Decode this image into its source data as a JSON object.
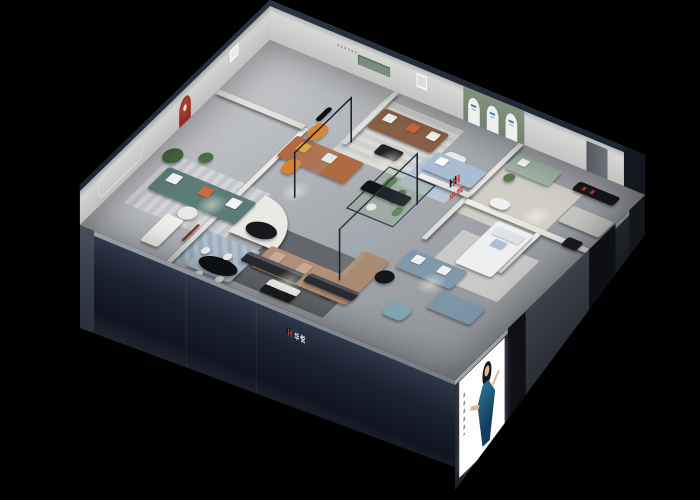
{
  "brand": {
    "logo_letter": "H",
    "name": "华悦"
  },
  "signs": {
    "interior": {
      "text": "华悦",
      "color": "#c0392b"
    },
    "fascia": {
      "text": "华悦",
      "color": "#eeeeee"
    }
  },
  "poster": {
    "title": "model in blue dress lightbox poster"
  },
  "palette": {
    "background": "#000000",
    "exterior_wall": "#1a2130",
    "wall_cap": "#2b3242",
    "interior_wall": "#eceae6",
    "floor": "#aaadb2",
    "accent_red_niche": "#8e2d24",
    "brand_red": "#d23b2e",
    "sage_green_wall": "#7b8d80",
    "tan_sofa": "#b29078",
    "teal_sofa": "#5c7c7a",
    "brown_leather_sofa": "#8a6047",
    "orange_accent": "#d9812f",
    "blue_grey_sofa": "#8199ab",
    "glass_frame": "#1c2431"
  }
}
